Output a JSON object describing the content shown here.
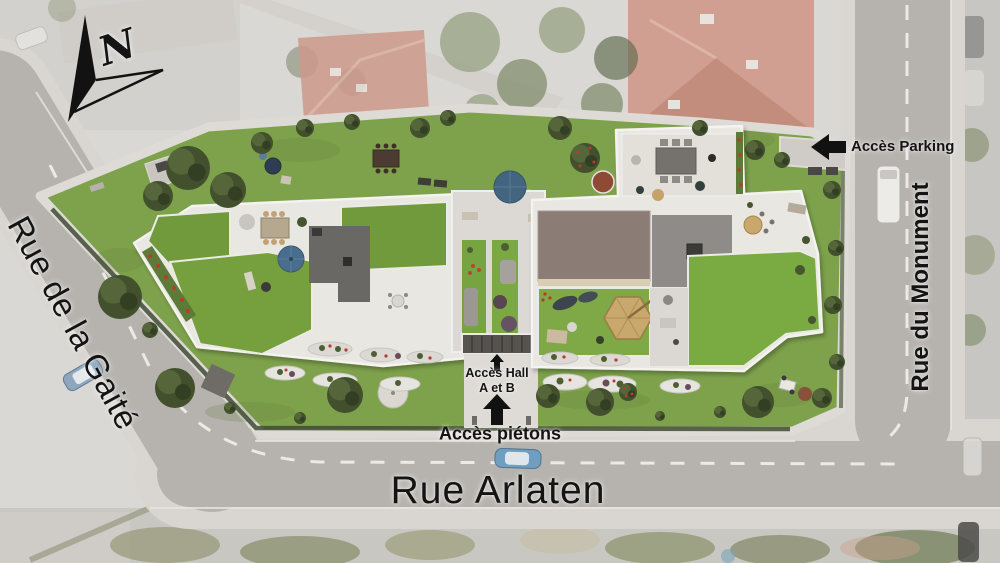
{
  "plan": {
    "north_label": "N",
    "streets": {
      "gaite": {
        "name": "Rue de la Gaité"
      },
      "arlaten": {
        "name": "Rue Arlaten"
      },
      "monument": {
        "name": "Rue du Monument"
      }
    },
    "access": {
      "parking": {
        "label": "Accès Parking"
      },
      "hall": {
        "line1": "Accès Hall",
        "line2": "A et B"
      },
      "pedestrian": {
        "label": "Accès piétons"
      }
    },
    "icons": {
      "north_arrow": "compass-north-arrow",
      "parking_arrow": "arrow-left",
      "hall_arrow": "arrow-up",
      "pedestrian_arrow": "arrow-up"
    },
    "colors": {
      "street": "#b6b3ae",
      "sidewalk": "#d9d6d1",
      "site_lawn": "#7ea24c",
      "roof_lawn": "#6f9a3a",
      "terrace_white": "#e9e7e2",
      "roof_dark_gray": "#6b6865",
      "roof_gray": "#8e8b88",
      "roof_brown": "#8b7b74",
      "hedge": "#414b36",
      "flowers_red": "#b83a2c",
      "parasol_blue": "#44657f",
      "parasol_tan": "#c8a86c",
      "label_text": "#141414"
    }
  }
}
